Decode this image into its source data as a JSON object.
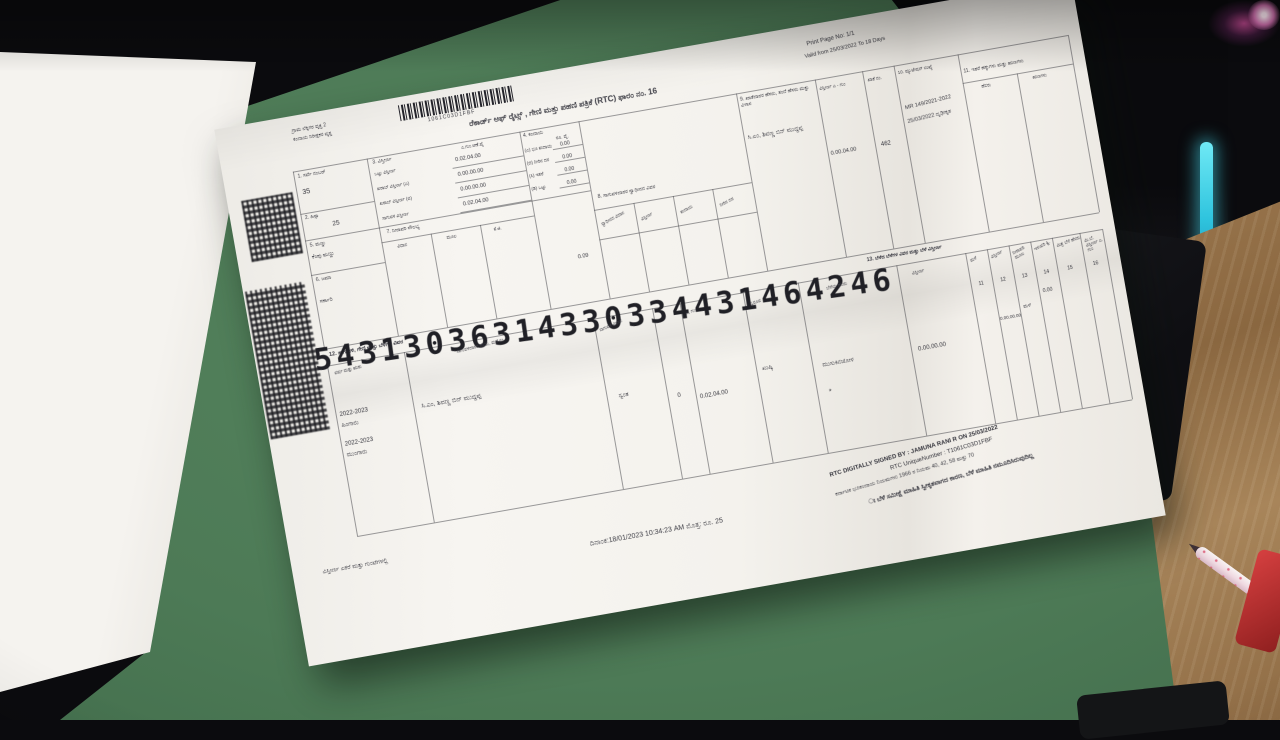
{
  "scene": {
    "colors": {
      "background": "#0b0b0e",
      "mat_green": "#4d7a56",
      "desk_wood": "#8a6740",
      "paper": "#f4f2ed",
      "led_cyan": "#2fc4de",
      "glow_pink": "#db52a4",
      "pen_pink": "#efd9e1",
      "red_item": "#c03434"
    }
  },
  "document": {
    "top": {
      "office_line1": "ಗ್ರಾಮ ಲೆಕ್ಕಿಗರ ವೃತ್ತ 2",
      "office_line2": "ಕಂದಾಯ ನಿರೀಕ್ಷಕರ ವೃತ್ತ",
      "barcode_number": "1061C03D1FBF",
      "title": "ರೆಕಾರ್ಡ್ ಆಫ್ ರೈಟ್ಸ್ , ಗೇಣಿ ಮತ್ತು ಪಹಣಿ ಪತ್ರಿಕೆ (RTC) ಫಾರಂ ನಂ. 16",
      "print_page": "Print Page No: 1/1",
      "validity": "Valid from 25/03/2022 To 18 Days"
    },
    "fields": {
      "survey": {
        "label": "1. ಸರ್ವೆ ನಂಬರ್",
        "value": "35"
      },
      "hissa": {
        "label": "2. ಹಿಸ್ಸಾ",
        "value": "25"
      },
      "soil": {
        "label": "5. ಮಣ್ಣು",
        "value": "ಕೆಂಪು ಮಣ್ಣು"
      },
      "jama": {
        "label": "6. ಜಮಾ",
        "value": "ಸರ್ಕಾರಿ"
      },
      "extent": {
        "label": "3. ವಿಸ್ತೀರ್ಣ",
        "unit": "ಎ.ಗುಂ.ಆಣೆ.ಪೈ",
        "rows": [
          {
            "label": "ಒಟ್ಟು ವಿಸ್ತೀರ್ಣ",
            "value": "0.02.04.00"
          },
          {
            "label": "ಖರಾಬ್ ವಿಸ್ತೀರ್ಣ (ಎ)",
            "value": "0.00.00.00"
          },
          {
            "label": "ಖರಾಬ್ ವಿಸ್ತೀರ್ಣ (ಬಿ)",
            "value": "0.00.00.00"
          },
          {
            "label": "ಸಾಗುವಳಿ ವಿಸ್ತೀರ್ಣ",
            "value": "0.02.04.00"
          }
        ]
      },
      "revenue": {
        "label": "4. ಕಂದಾಯ",
        "unit": "ರೂ. ಪೈ.",
        "rows": [
          {
            "label": "(ಎ) ಭೂ ಕಂದಾಯ",
            "value": "0.00"
          },
          {
            "label": "(ಬಿ) ನೀರಿನ ದರ",
            "value": "0.00"
          },
          {
            "label": "(ಸಿ) ಇತರೆ",
            "value": "0.00"
          },
          {
            "label": "(ಡಿ) ಒಟ್ಟು",
            "value": "0.00"
          }
        ],
        "total": "0.09"
      },
      "irrigation": {
        "label": "7. ನೀರಾವರಿ ಸೌಲಭ್ಯ",
        "cols": [
          "ವಿಧಾನ",
          "ಮೂಲ",
          "ಕೆ.ಜಿ."
        ]
      },
      "possession": {
        "label": "8. ಸಾಗುವಳಿದಾರರ ಸ್ವಾಧೀನದ ವಿವರ",
        "cols": [
          "ಸ್ವಾಧೀನದ ವಿಧಾನ",
          "ವಿಸ್ತೀರ್ಣ",
          "ಕಂದಾಯ",
          "ನೀರಿನ ದರ"
        ]
      },
      "owner": {
        "label": "9. ಖಾತೆದಾರರ ಹೆಸರು, ತಂದೆ ಹೆಸರು ಮತ್ತು ವಿಳಾಸ",
        "name": "ಸಿ.ಎಂ, ಶಿವಣ್ಣ ಬಿನ್ ಮುದ್ದಪ್ಪ",
        "extent_label": "ವಿಸ್ತೀರ್ಣ ಎ - ಗುಂ",
        "extent": "0.00.04.00",
        "khata_label": "ಖಾತೆ ನಂ.",
        "khata": "462"
      },
      "mutation": {
        "label": "10. ಮ್ಯುಟೇಷನ್ ಸಂಖ್ಯೆ",
        "value1": "MR 149/2021-2022",
        "value2": "25/03/2022 ದೃಢೀಕೃತ"
      },
      "other_rights": {
        "label": "11. ಇತರೆ ಹಕ್ಕುಗಳು ಮತ್ತು ಋಣಗಳು",
        "cols": [
          "ಹೆಸರು",
          "ಋಣಗಳು"
        ]
      }
    },
    "serial_number": "54313036314330334431464246",
    "cultivation": {
      "section_label": "12. ಸಾಗುವಳಿ, ಗೇಣಿ ಮತ್ತು ಬೆಳೆಗಳ ವಿವರ",
      "crop_section_label": "13. ಬೆಳೆದ ಬೆಳೆಗಳ ವಿವರ ಮತ್ತು ಬೆಳೆ ವಿಸ್ತೀರ್ಣ",
      "col_year": "ವರ್ಷ ಮತ್ತು ಋತು",
      "col_name": "ಸಾಗುವಳಿದಾರರ ಹೆಸರು, ಮನೆ ನಂ.",
      "col_mode": "ಸಾಗುವಳಿ ವಿಧಾನ",
      "col_extent": "ಎ, ಗುಂ",
      "col_nature": "ಸ್ವರೂಪ",
      "col_crop": "ಬೆಳೆಯ ಹೆಸರು",
      "col_crop_extent": "ವಿಸ್ತೀರ್ಣ",
      "numbered_cols": [
        {
          "no": "11",
          "label": "ಮಳೆ"
        },
        {
          "no": "12",
          "label": "ವಿಸ್ತೀರ್ಣ"
        },
        {
          "no": "13",
          "label": "ನೀರಾವರಿ ಮೂಲ"
        },
        {
          "no": "14",
          "label": "ಇಳುವರಿ ಕ್ವಿ."
        },
        {
          "no": "15",
          "label": "ಮಿಶ್ರ ಬೆಳೆ ಹೆಸರು"
        },
        {
          "no": "16",
          "label": "ಮಿ.ಬೆ. ವಿಸ್ತೀರ್ಣ ಎ. ಗುಂ"
        }
      ],
      "row": {
        "year1": "2022-2023",
        "season1": "ಹಿಂಗಾರು",
        "year2": "2022-2023",
        "season2": "ಮುಂಗಾರು",
        "name": "ಸಿ.ಎಂ, ಶಿವಣ್ಣ ಬಿನ್ ಮುದ್ದಪ್ಪ",
        "mode": "ಸ್ವಂತ",
        "flag": "0",
        "extent": "0.02.04.00",
        "nature": "ಖುಷ್ಕಿ",
        "crop": "ಮುಸುಕಿನಜೋಳ",
        "star": "*",
        "crop_extent": "0.00.00.00",
        "col12_value": "0.00.00.00",
        "col13_value": "ಮಳೆ",
        "col14_value": "0.00"
      }
    },
    "footer": {
      "note_left": "ವಿಸ್ತೀರ್ಣ ಎಕರೆ ಮತ್ತು ಗುಂಟೆಗಳಲ್ಲಿ",
      "date_line": "ದಿನಾಂಕ:18/01/2023  10:34:23 AM  ಮೊತ್ತ: ರೂ.  25",
      "signed": "RTC DIGITALLY SIGNED BY : JAMUNA RANI R ON 25/03/2022",
      "unique": "RTC UniqueNumber :      T1061C03D1FBF",
      "rule": "ಕರ್ನಾಟಕ ಭೂಕಂದಾಯ ನಿಯಮಗಳು 1966 ರ ನಿಯಮ 40, 42, 58 ಮತ್ತು 70",
      "crop_note": "ಃ ಬೆಳೆ ಸಮೀಕ್ಷೆ ಮಾಹಿತಿ ಸ್ವೀಕೃತವಾಗದ ಕಾರಣ, ಬೆಳೆ ಮಾಹಿತಿ ನಮೂದಿಸಿರುವುದಿಲ್ಲ"
    }
  }
}
